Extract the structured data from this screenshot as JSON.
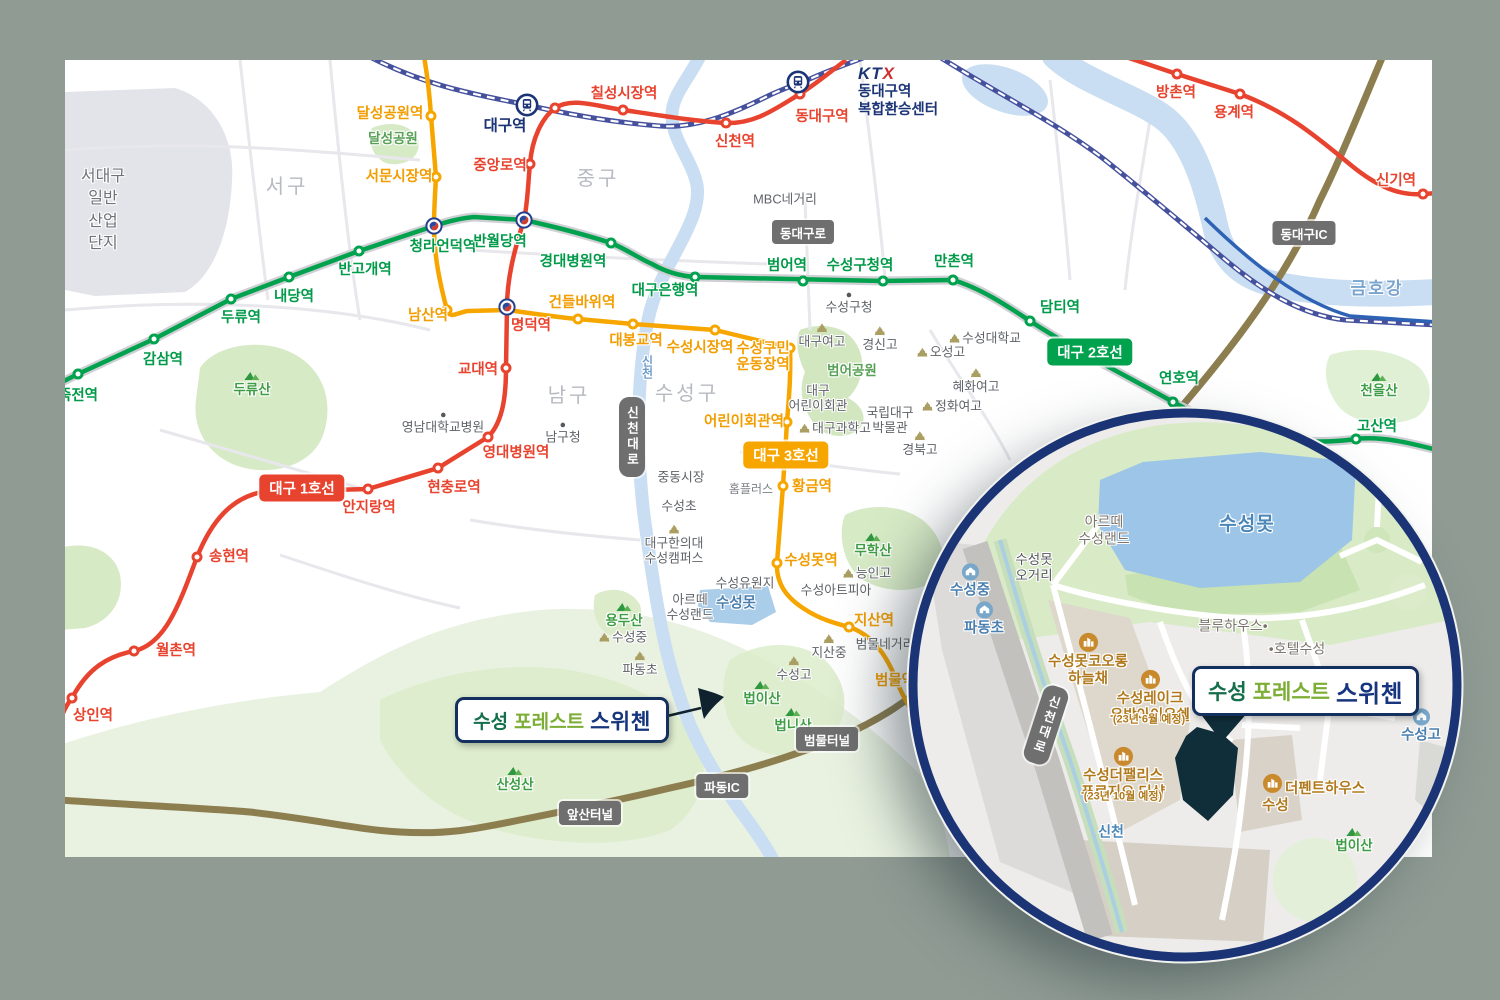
{
  "colors": {
    "bg": "#8f9b93",
    "panel": "#ffffff",
    "line1": "#e8432e",
    "line2": "#00a24d",
    "line3": "#f7a600",
    "rail": "#46519e",
    "rail_blue": "#2d62b4",
    "water": "#c9def2",
    "water_deep": "#9cc5e7",
    "park": "#d7eac6",
    "park_dark": "#cfe5ba",
    "park_pale": "#e9f2e1",
    "industrial": "#e3e3ea",
    "road_casing": "#cfcfd5",
    "street": "#e9e9ee",
    "expressway": "#8d7e50",
    "badge_gray": "#6f6f6f",
    "navy": "#1b3476",
    "site": "#102d3a",
    "inset_bg": "#edecea",
    "inset_block": "#ded7cc",
    "inset_road": "#c3c1be"
  },
  "callout": {
    "part1": "수성",
    "part2": "포레스트",
    "part3": "스위첸"
  },
  "ktx": {
    "logo_kt": "KT",
    "logo_x": "X",
    "line1": "동대구역",
    "line2": "복합환승센터"
  },
  "map": {
    "line_badges": [
      {
        "t": "대구 1호선",
        "x": 302,
        "y": 488,
        "l": 1
      },
      {
        "t": "대구 2호선",
        "x": 1090,
        "y": 352,
        "l": 2
      },
      {
        "t": "대구 3호선",
        "x": 786,
        "y": 455,
        "l": 3
      }
    ],
    "road_badges": [
      {
        "t": "동대구로",
        "x": 803,
        "y": 232
      },
      {
        "t": "동대구IC",
        "x": 1304,
        "y": 233
      },
      {
        "t": "신천대로",
        "x": 632,
        "y": 437,
        "v": 1
      },
      {
        "t": "앞산터널",
        "x": 590,
        "y": 813
      },
      {
        "t": "파동IC",
        "x": 722,
        "y": 786
      },
      {
        "t": "범물터널",
        "x": 827,
        "y": 739
      }
    ],
    "stations": [
      {
        "n": "상인역",
        "x": 72,
        "y": 698,
        "l": 1,
        "lx": 93,
        "ly": 716
      },
      {
        "n": "월촌역",
        "x": 134,
        "y": 651,
        "l": 1,
        "lx": 176,
        "ly": 651
      },
      {
        "n": "송현역",
        "x": 197,
        "y": 557,
        "l": 1,
        "lx": 229,
        "ly": 557
      },
      {
        "n": "안지랑역",
        "x": 368,
        "y": 489,
        "l": 1,
        "lx": 369,
        "ly": 508
      },
      {
        "n": "현충로역",
        "x": 438,
        "y": 468,
        "l": 1,
        "lx": 454,
        "ly": 488
      },
      {
        "n": "영대병원역",
        "x": 488,
        "y": 437,
        "l": 1,
        "lx": 516,
        "ly": 453
      },
      {
        "n": "교대역",
        "x": 506,
        "y": 368,
        "l": 1,
        "lx": 478,
        "ly": 370
      },
      {
        "n": "명덕역",
        "x": 507,
        "y": 307,
        "l": 1,
        "t": "tr",
        "lx": 531,
        "ly": 326
      },
      {
        "n": "중앙로역",
        "x": 530,
        "y": 164,
        "l": 1,
        "lx": 500,
        "ly": 166
      },
      {
        "n": "",
        "x": 555,
        "y": 108,
        "l": 1
      },
      {
        "n": "칠성시장역",
        "x": 623,
        "y": 110,
        "l": 1,
        "lx": 624,
        "ly": 94
      },
      {
        "n": "신천역",
        "x": 726,
        "y": 123,
        "l": 1,
        "lx": 735,
        "ly": 142
      },
      {
        "n": "동대구역",
        "x": 800,
        "y": 94,
        "l": 1,
        "lx": 822,
        "ly": 117
      },
      {
        "n": "방촌역",
        "x": 1177,
        "y": 74,
        "l": 1,
        "lx": 1176,
        "ly": 93
      },
      {
        "n": "용계역",
        "x": 1240,
        "y": 94,
        "l": 1,
        "lx": 1234,
        "ly": 113
      },
      {
        "n": "신기역",
        "x": 1423,
        "y": 194,
        "l": 1,
        "lx": 1396,
        "ly": 181
      },
      {
        "n": "죽전역",
        "x": 78,
        "y": 374,
        "l": 2,
        "lx": 78,
        "ly": 396
      },
      {
        "n": "감삼역",
        "x": 154,
        "y": 339,
        "l": 2,
        "lx": 163,
        "ly": 360
      },
      {
        "n": "두류역",
        "x": 231,
        "y": 299,
        "l": 2,
        "lx": 241,
        "ly": 318
      },
      {
        "n": "내당역",
        "x": 289,
        "y": 277,
        "l": 2,
        "lx": 294,
        "ly": 297
      },
      {
        "n": "반고개역",
        "x": 359,
        "y": 251,
        "l": 2,
        "lx": 365,
        "ly": 270
      },
      {
        "n": "청라언덕역",
        "x": 434,
        "y": 226,
        "l": 2,
        "t": "tr",
        "lx": 443,
        "ly": 247
      },
      {
        "n": "반월당역",
        "x": 524,
        "y": 220,
        "l": 2,
        "t": "tr",
        "lx": 500,
        "ly": 242
      },
      {
        "n": "경대병원역",
        "x": 611,
        "y": 243,
        "l": 2,
        "lx": 573,
        "ly": 262
      },
      {
        "n": "대구은행역",
        "x": 695,
        "y": 277,
        "l": 2,
        "lx": 665,
        "ly": 291
      },
      {
        "n": "범어역",
        "x": 803,
        "y": 281,
        "l": 2,
        "lx": 787,
        "ly": 266
      },
      {
        "n": "수성구청역",
        "x": 883,
        "y": 281,
        "l": 2,
        "lx": 860,
        "ly": 266
      },
      {
        "n": "만촌역",
        "x": 953,
        "y": 280,
        "l": 2,
        "lx": 954,
        "ly": 262
      },
      {
        "n": "담티역",
        "x": 1030,
        "y": 321,
        "l": 2,
        "lx": 1060,
        "ly": 308
      },
      {
        "n": "연호역",
        "x": 1173,
        "y": 402,
        "l": 2,
        "lx": 1179,
        "ly": 379
      },
      {
        "n": "고산역",
        "x": 1356,
        "y": 439,
        "l": 2,
        "lx": 1377,
        "ly": 427
      },
      {
        "n": "달성공원역",
        "x": 431,
        "y": 116,
        "l": 3,
        "lx": 390,
        "ly": 114
      },
      {
        "n": "서문시장역",
        "x": 436,
        "y": 177,
        "l": 3,
        "lx": 399,
        "ly": 177
      },
      {
        "n": "남산역",
        "x": 447,
        "y": 310,
        "l": 3,
        "lx": 428,
        "ly": 316
      },
      {
        "n": "건들바위역",
        "x": 578,
        "y": 319,
        "l": 3,
        "lx": 582,
        "ly": 303
      },
      {
        "n": "대봉교역",
        "x": 633,
        "y": 324,
        "l": 3,
        "lx": 636,
        "ly": 341
      },
      {
        "n": "수성시장역",
        "x": 715,
        "y": 330,
        "l": 3,
        "lx": 700,
        "ly": 348
      },
      {
        "n": "수성구민\n운동장역",
        "x": 790,
        "y": 348,
        "l": 3,
        "lx": 763,
        "ly": 357
      },
      {
        "n": "어린이회관역",
        "x": 787,
        "y": 422,
        "l": 3,
        "lx": 744,
        "ly": 422
      },
      {
        "n": "황금역",
        "x": 783,
        "y": 486,
        "l": 3,
        "lx": 812,
        "ly": 487
      },
      {
        "n": "수성못역",
        "x": 777,
        "y": 563,
        "l": 3,
        "lx": 811,
        "ly": 561
      },
      {
        "n": "지산역",
        "x": 849,
        "y": 627,
        "l": 3,
        "lx": 874,
        "ly": 621
      },
      {
        "n": "범물역",
        "x": 913,
        "y": 703,
        "l": 3,
        "lx": 895,
        "ly": 681
      },
      {
        "n": "대구역",
        "x": 527,
        "y": 105,
        "t": "rail",
        "lx": 505,
        "ly": 126
      },
      {
        "n": "",
        "x": 798,
        "y": 82,
        "t": "rail"
      }
    ],
    "labels": [
      {
        "t": "서대구\n일반\n산업\n단지",
        "x": 103,
        "y": 211,
        "c": "industrial"
      },
      {
        "t": "서구",
        "x": 287,
        "y": 188,
        "c": "district"
      },
      {
        "t": "중구",
        "x": 598,
        "y": 180,
        "c": "district"
      },
      {
        "t": "남구",
        "x": 569,
        "y": 397,
        "c": "district"
      },
      {
        "t": "수성구",
        "x": 687,
        "y": 395,
        "c": "district"
      },
      {
        "t": "달성공원",
        "x": 393,
        "y": 139,
        "c": "parkname"
      },
      {
        "t": "범어공원",
        "x": 852,
        "y": 371,
        "c": "parkname"
      },
      {
        "t": "두류산",
        "x": 252,
        "y": 384,
        "c": "mountain",
        "ic": "mtn-a"
      },
      {
        "t": "무학산",
        "x": 873,
        "y": 545,
        "c": "mountain",
        "ic": "mtn-a"
      },
      {
        "t": "용두산",
        "x": 624,
        "y": 615,
        "c": "mountain",
        "ic": "mtn-a"
      },
      {
        "t": "법이산",
        "x": 762,
        "y": 693,
        "c": "mountain",
        "ic": "mtn-a"
      },
      {
        "t": "법니산",
        "x": 793,
        "y": 720,
        "c": "mountain",
        "ic": "mtn-a"
      },
      {
        "t": "산성산",
        "x": 515,
        "y": 779,
        "c": "mountain",
        "ic": "mtn-a"
      },
      {
        "t": "천을산",
        "x": 1379,
        "y": 385,
        "c": "mountain",
        "ic": "mtn-a"
      },
      {
        "t": "금호강",
        "x": 1377,
        "y": 289,
        "c": "water-big"
      },
      {
        "t": "수성못",
        "x": 736,
        "y": 604,
        "c": "water"
      },
      {
        "t": "신천",
        "x": 647,
        "y": 367,
        "c": "water-v"
      },
      {
        "t": "MBC네거리",
        "x": 785,
        "y": 199,
        "c": "fac"
      },
      {
        "t": "수성구청",
        "x": 849,
        "y": 303,
        "c": "fac",
        "ic": "dot-a"
      },
      {
        "t": "영남대학교병원",
        "x": 443,
        "y": 423,
        "c": "fac",
        "ic": "dot-a"
      },
      {
        "t": "남구청",
        "x": 563,
        "y": 433,
        "c": "fac",
        "ic": "dot-a"
      },
      {
        "t": "중동시장",
        "x": 681,
        "y": 477,
        "c": "fac"
      },
      {
        "t": "홈플러스",
        "x": 751,
        "y": 489,
        "c": "fac-sm"
      },
      {
        "t": "수성초",
        "x": 679,
        "y": 506,
        "c": "fac"
      },
      {
        "t": "대구한의대\n수성캠퍼스",
        "x": 674,
        "y": 545,
        "c": "fac",
        "ic": "bld-a"
      },
      {
        "t": "수성유원지",
        "x": 745,
        "y": 583,
        "c": "fac"
      },
      {
        "t": "아르떼\n수성랜드",
        "x": 690,
        "y": 607,
        "c": "fac"
      },
      {
        "t": "수성아트피아",
        "x": 836,
        "y": 590,
        "c": "fac"
      },
      {
        "t": "능인고",
        "x": 867,
        "y": 573,
        "c": "fac",
        "ic": "bld-l"
      },
      {
        "t": "지산중",
        "x": 829,
        "y": 647,
        "c": "fac",
        "ic": "bld-a"
      },
      {
        "t": "범물네거리",
        "x": 885,
        "y": 644,
        "c": "fac"
      },
      {
        "t": "수성고",
        "x": 794,
        "y": 669,
        "c": "fac",
        "ic": "bld-a"
      },
      {
        "t": "수성중",
        "x": 623,
        "y": 637,
        "c": "fac",
        "ic": "bld-l"
      },
      {
        "t": "파동초",
        "x": 640,
        "y": 664,
        "c": "fac",
        "ic": "bld-a"
      },
      {
        "t": "대구여고",
        "x": 822,
        "y": 336,
        "c": "fac",
        "ic": "bld-a"
      },
      {
        "t": "경신고",
        "x": 880,
        "y": 339,
        "c": "fac",
        "ic": "bld-a"
      },
      {
        "t": "오성고",
        "x": 941,
        "y": 352,
        "c": "fac",
        "ic": "bld-l"
      },
      {
        "t": "수성대학교",
        "x": 985,
        "y": 338,
        "c": "fac",
        "ic": "bld-l"
      },
      {
        "t": "혜화여고",
        "x": 976,
        "y": 381,
        "c": "fac",
        "ic": "bld-a"
      },
      {
        "t": "정화여고",
        "x": 952,
        "y": 406,
        "c": "fac",
        "ic": "bld-l"
      },
      {
        "t": "국립대구\n박물관",
        "x": 890,
        "y": 420,
        "c": "fac"
      },
      {
        "t": "대구과학고",
        "x": 835,
        "y": 428,
        "c": "fac",
        "ic": "bld-l"
      },
      {
        "t": "경북고",
        "x": 920,
        "y": 444,
        "c": "fac",
        "ic": "bld-a"
      },
      {
        "t": "대구\n어린이회관",
        "x": 818,
        "y": 398,
        "c": "fac"
      }
    ]
  },
  "inset": {
    "road_badge": {
      "t": "신천대로",
      "x": 1046,
      "y": 725
    },
    "labels": [
      {
        "t": "수성못",
        "x": 1247,
        "y": 525,
        "c": "water-in"
      },
      {
        "t": "아르떼\n수성랜드",
        "x": 1104,
        "y": 530,
        "c": "insetgray"
      },
      {
        "t": "수성못\n오거리",
        "x": 1034,
        "y": 568,
        "c": "insetdark"
      },
      {
        "t": "수성중",
        "x": 970,
        "y": 581,
        "c": "school",
        "ic": "sch-a"
      },
      {
        "t": "파동초",
        "x": 984,
        "y": 619,
        "c": "school",
        "ic": "sch-a"
      },
      {
        "t": "수성못코오롱\n하늘채",
        "x": 1088,
        "y": 660,
        "c": "apt",
        "ic": "apt-a"
      },
      {
        "t": "수성레이크\n우방아이유쉘",
        "x": 1150,
        "y": 697,
        "c": "apt",
        "ic": "apt-a"
      },
      {
        "t": "(23년 6월 예정)",
        "x": 1149,
        "y": 720,
        "c": "aptnote"
      },
      {
        "t": "수성더팰리스\n푸르지오 더샵",
        "x": 1123,
        "y": 774,
        "c": "apt",
        "ic": "apt-a"
      },
      {
        "t": "(23년 10월 예정)",
        "x": 1123,
        "y": 797,
        "c": "aptnote"
      },
      {
        "t": "블루하우스•",
        "x": 1233,
        "y": 626,
        "c": "insetgray"
      },
      {
        "t": "•호텔수성",
        "x": 1297,
        "y": 649,
        "c": "insetgray"
      },
      {
        "t": "더펜트하우스\n수성",
        "x": 1262,
        "y": 794,
        "c": "apt",
        "a": "l",
        "ic": "apt-l"
      },
      {
        "t": "수성고",
        "x": 1421,
        "y": 726,
        "c": "school",
        "ic": "sch-a"
      },
      {
        "t": "법이산",
        "x": 1354,
        "y": 840,
        "c": "mountain",
        "ic": "mtn-a"
      },
      {
        "t": "신천",
        "x": 1111,
        "y": 832,
        "c": "water-sm"
      }
    ]
  }
}
